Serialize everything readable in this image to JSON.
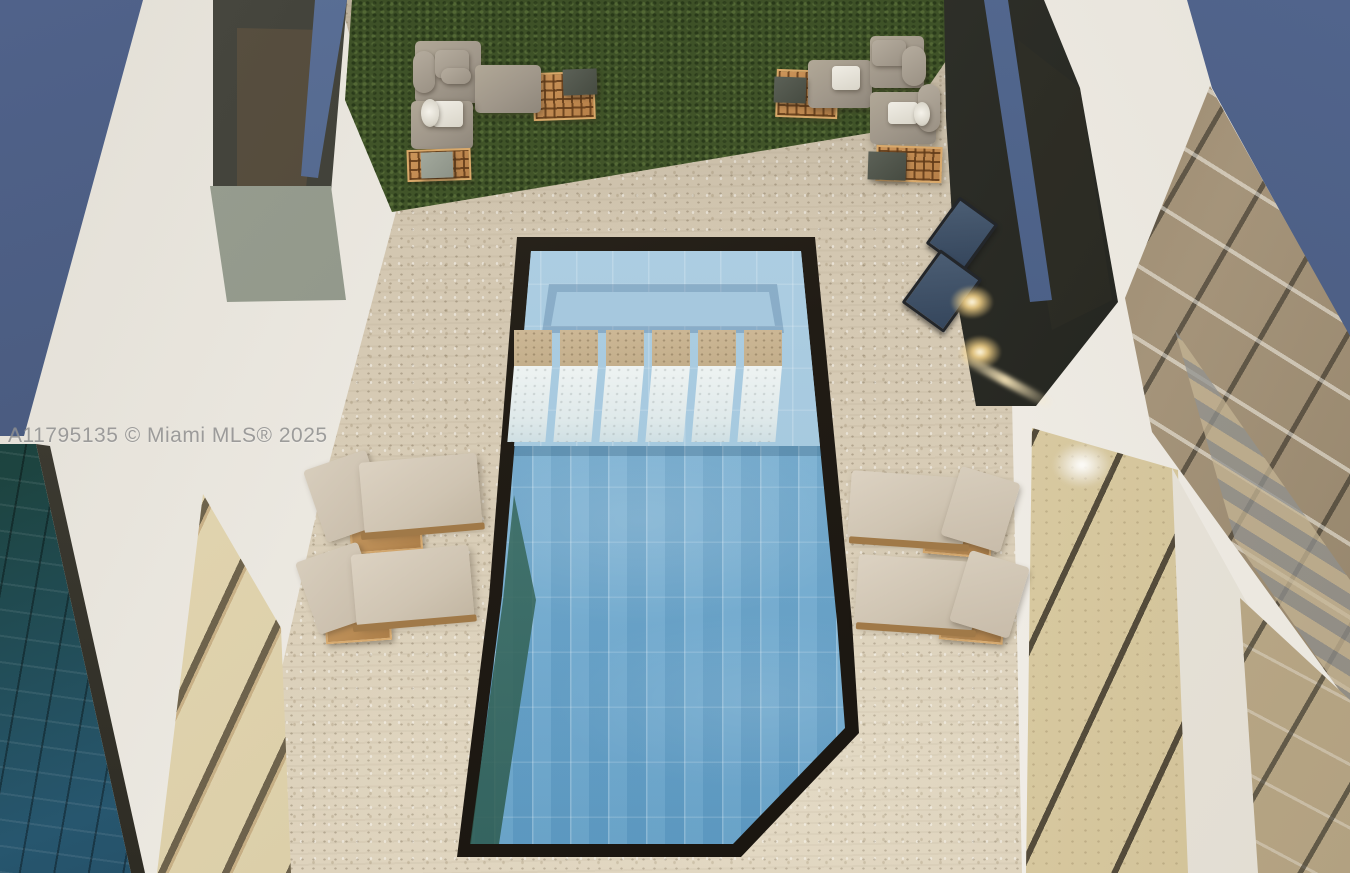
{
  "watermark": {
    "text": "A11795135 © Miami MLS® 2025"
  },
  "scene": {
    "description": "Aerial 3D rendering of a modern home backyard: rectangular blue-tiled pool with baja shelf and six travertine fountain pillars, travertine deck, two pairs of sun loungers, two outdoor sofa sets on lattice platforms, grass lawn, outdoor bar with two stools, white walls, slate-blue roof planes and glass atrium walls."
  },
  "palette": {
    "deck": "#d6cab3",
    "grass": "#44552c",
    "water_deep": "#6aa5cb",
    "water_shallow": "#a4c8de",
    "coping": "#211c15",
    "roof_blue": "#47587a",
    "wall_white": "#f1eee8",
    "glass_teal": "#1d4440",
    "louver_beige": "#e0d3ae",
    "wood": "#c08a52",
    "cushion_gray": "#a0978a",
    "lounger_cushion": "#cfc4b2"
  }
}
